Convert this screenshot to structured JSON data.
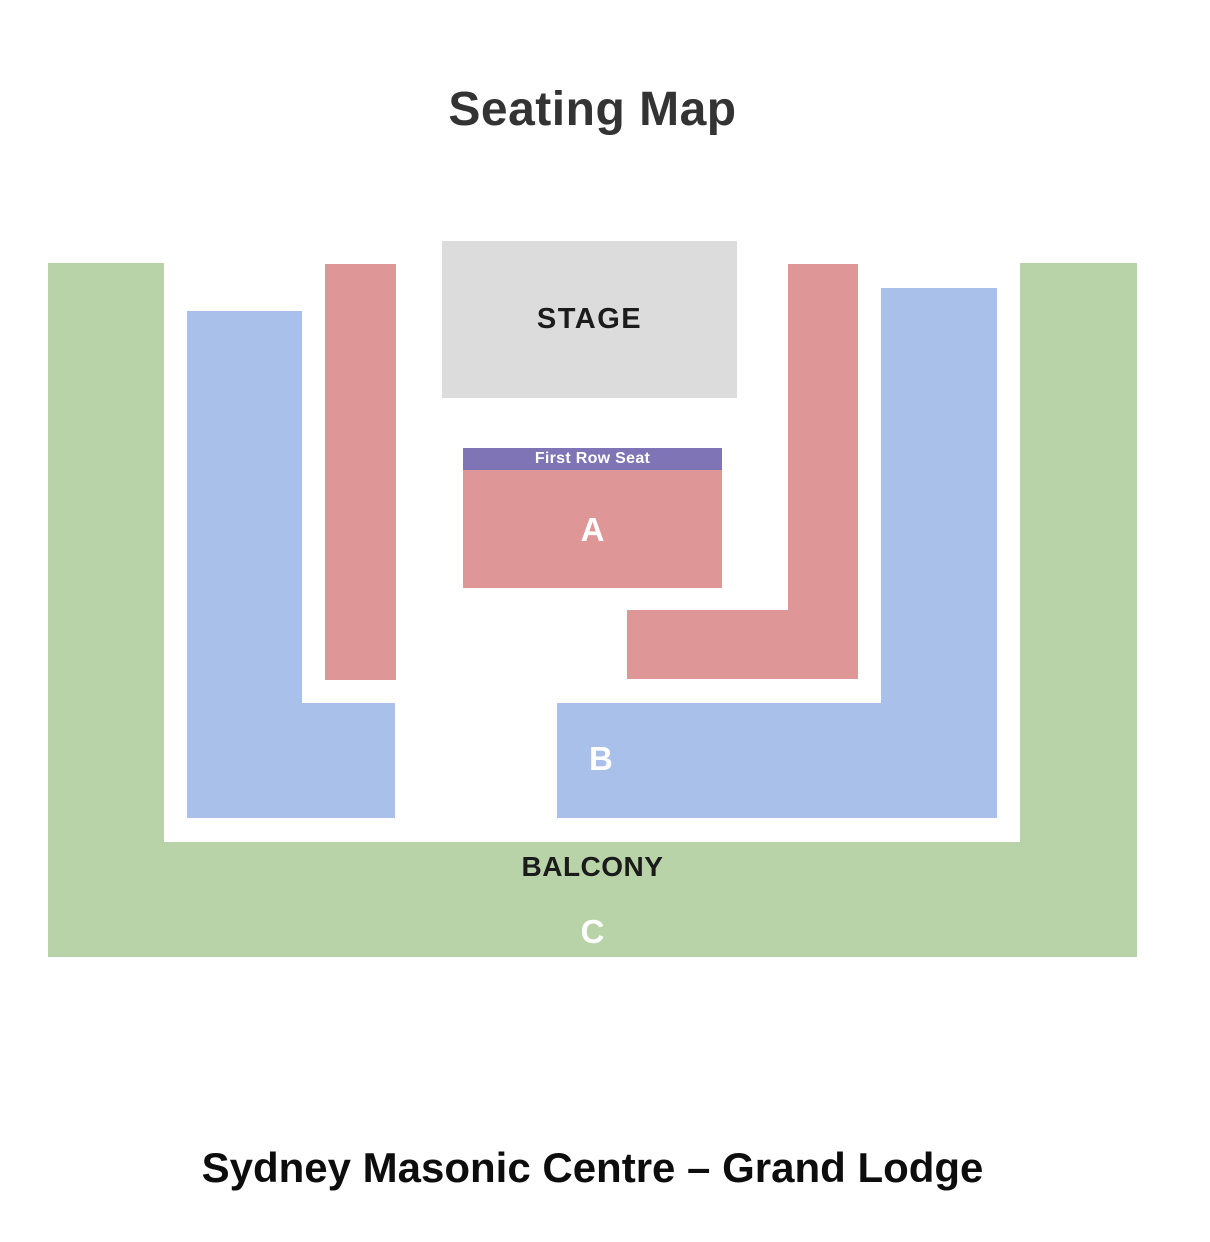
{
  "title": "Seating Map",
  "venue": "Sydney Masonic Centre – Grand Lodge",
  "stage": {
    "label": "STAGE",
    "color": "#dcdcdc"
  },
  "sections": {
    "first_row": {
      "label": "First Row Seat",
      "color": "#7f74b5",
      "text_color": "#ffffff"
    },
    "a": {
      "label": "A",
      "color": "#de9697",
      "text_color": "#ffffff"
    },
    "b": {
      "label": "B",
      "color": "#a9c0ea",
      "text_color": "#ffffff"
    },
    "c": {
      "label": "C",
      "text_color": "#ffffff"
    },
    "balcony": {
      "label": "BALCONY",
      "color": "#b9d3a8",
      "text_color": "#1b1b1b"
    }
  }
}
